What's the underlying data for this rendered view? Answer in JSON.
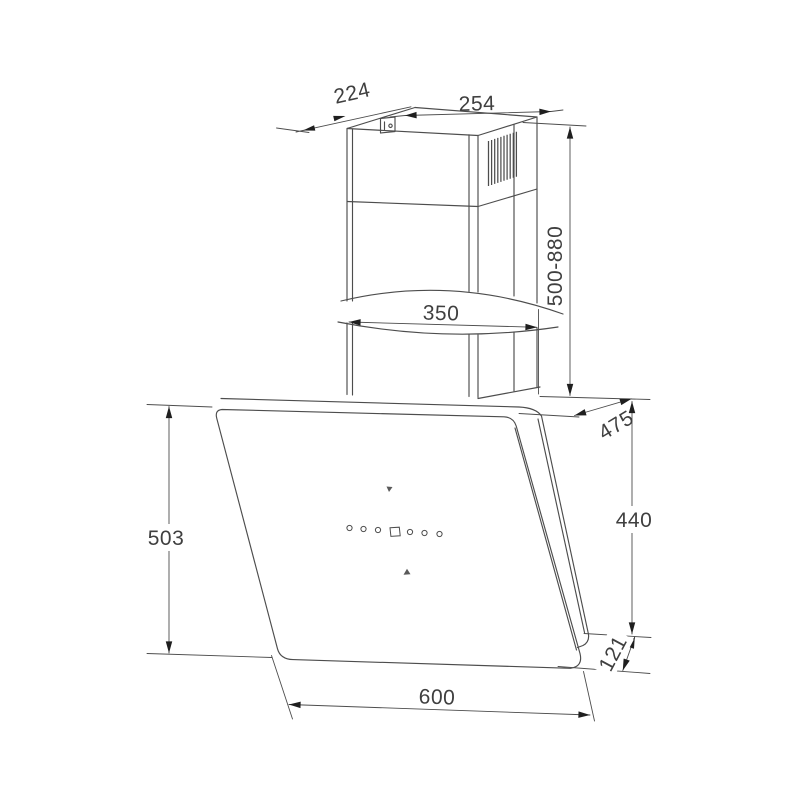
{
  "drawing": {
    "title": "wall-mounted-angled-cooker-hood-dimension-drawing",
    "colors": {
      "line": "#4d4d4d",
      "arrow": "#1f1f1f",
      "text": "#3f3f3f",
      "background": "#ffffff"
    },
    "dimensions": {
      "chimney_top_depth": "224",
      "chimney_top_width": "254",
      "chimney_height_range": "500-880",
      "chimney_base_width": "350",
      "hood_depth": "475",
      "hood_front_height": "503",
      "hood_back_height": "440",
      "bottom_edge_offset": "121",
      "hood_width": "600"
    }
  }
}
